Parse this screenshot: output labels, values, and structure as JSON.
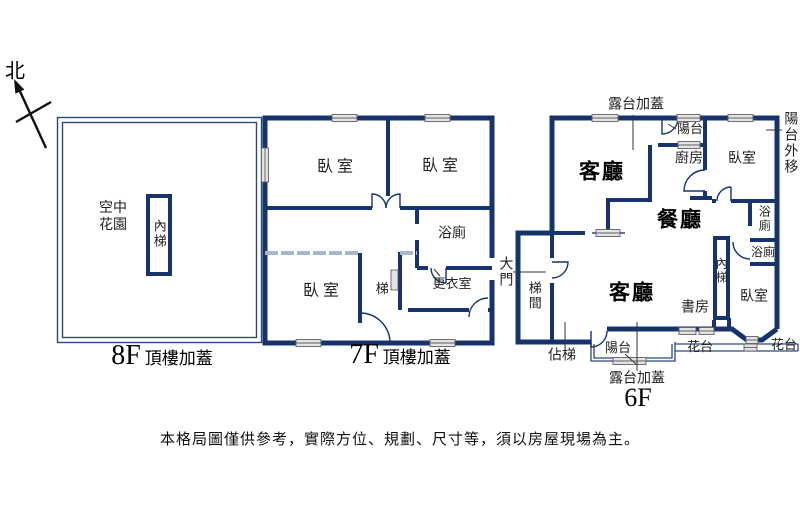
{
  "north_label": "北",
  "disclaimer": "本格局圖僅供參考，實際方位、規劃、尺寸等，須以房屋現場為主。",
  "floor_8f": {
    "caption_floor": "8F",
    "caption_suffix": "頂樓加蓋",
    "rooms": {
      "sky_garden": "空中花園",
      "inner_stairs": "內梯"
    }
  },
  "floor_7f": {
    "caption_floor": "7F",
    "caption_suffix": "頂樓加蓋",
    "rooms": {
      "bedroom_top_left": "臥室",
      "bedroom_top_right": "臥室",
      "bedroom_bottom": "臥室",
      "bathroom": "浴廁",
      "dressing_room": "更衣室",
      "stairs": "梯"
    }
  },
  "floor_6f": {
    "caption_floor": "6F",
    "rooms": {
      "living_room_top": "客廳",
      "living_room_bottom": "客廳",
      "dining_room": "餐廳",
      "kitchen": "廚房",
      "bedroom_top": "臥室",
      "bedroom_bottom": "臥室",
      "balcony_top": "陽台",
      "balcony_bottom": "陽台",
      "bathroom_upper": "浴廁",
      "bathroom_lower": "浴廁",
      "inner_stairs": "內梯",
      "study": "書房",
      "stairwell": "梯間",
      "occupied_stairs": "佔梯",
      "flower_bed_left": "花台",
      "flower_bed_right": "花台"
    },
    "annotations": {
      "terrace_top": "露台加蓋",
      "terrace_bottom": "露台加蓋",
      "balcony_moved_out": "陽台外移",
      "main_door": "大門"
    }
  },
  "colors": {
    "wall": "#17336b",
    "thin_line": "#2d4a7a",
    "light_wall": "#a9b6cc",
    "window_fill": "#e3e3e3",
    "window_stroke": "#606060",
    "leader": "#333333"
  }
}
